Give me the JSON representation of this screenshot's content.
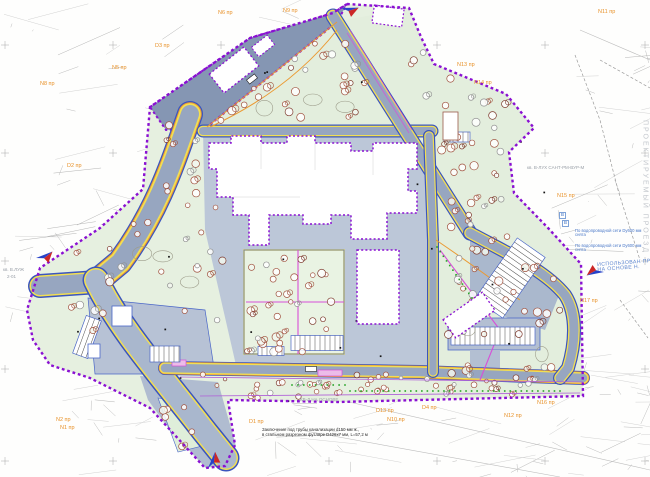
{
  "meta": {
    "drawing_type": "master-plan-site-drawing"
  },
  "palette": {
    "site_green": "#e6f0e0",
    "courtyard_green": "#e9f3e3",
    "road_slate": "#97a6c0",
    "parking_slate": "#8596b3",
    "paved_light": "#bcc7d8",
    "edge_yellow": "#f2df52",
    "curb_orange": "#eb9a33",
    "curb_blue": "#3b55be",
    "boundary_purple": "#8a10d2",
    "path_magenta": "#d84fd8",
    "tree_brick": "#a0523f",
    "tree_gray": "#909090",
    "dot_green": "#28a428",
    "label_orange": "#e8922a",
    "note_blue": "#4a78c8",
    "arrow_blue": "#2742c8",
    "arrow_red": "#cc2727"
  },
  "road_labels": [
    {
      "text": "N6 пр",
      "x": 218,
      "y": 11
    },
    {
      "text": "N9 пр",
      "x": 283,
      "y": 9
    },
    {
      "text": "N11 пр",
      "x": 598,
      "y": 10
    },
    {
      "text": "D3 пр",
      "x": 155,
      "y": 44
    },
    {
      "text": "N5 пр",
      "x": 112,
      "y": 66
    },
    {
      "text": "N8 пр",
      "x": 40,
      "y": 82
    },
    {
      "text": "D2 пр",
      "x": 67,
      "y": 164
    },
    {
      "text": "N13 пр",
      "x": 457,
      "y": 63
    },
    {
      "text": "N14 пр",
      "x": 474,
      "y": 81
    },
    {
      "text": "N15 пр",
      "x": 557,
      "y": 194
    },
    {
      "text": "N17 пр",
      "x": 580,
      "y": 299
    },
    {
      "text": "N16 пр",
      "x": 537,
      "y": 401
    },
    {
      "text": "N12 пр",
      "x": 504,
      "y": 414
    },
    {
      "text": "D4 пр",
      "x": 422,
      "y": 406
    },
    {
      "text": "D13 пр",
      "x": 376,
      "y": 409
    },
    {
      "text": "N10 пр",
      "x": 387,
      "y": 418
    },
    {
      "text": "D1 пр",
      "x": 249,
      "y": 420
    },
    {
      "text": "N2 пр",
      "x": 56,
      "y": 418
    },
    {
      "text": "N1 пр",
      "x": 60,
      "y": 426
    }
  ],
  "texture_labels": [
    {
      "text": "кв. В-ЛУХ  САНТ-РМ-ВУР-М",
      "x": 527,
      "y": 166
    },
    {
      "text": "кв. В.ЛУЖ",
      "x": 3,
      "y": 268
    },
    {
      "text": "2-01",
      "x": 7,
      "y": 275
    },
    {
      "text": "КВ-Л  НА ОСНОВЕ",
      "x": 300,
      "y": 398
    }
  ],
  "annotations": {
    "bottom_note": {
      "line1": "Заключение под трубы канализации d150 мм ж.,",
      "line2": "в стальном разрезном футляре D426х7 мм, L=57,2 м"
    },
    "route_note": {
      "line1": "ИСПОЛЬЗОВАН ПР.",
      "line2": "НА ОСНОВЕ Н."
    },
    "water_notes": [
      {
        "line1": "По водопроводной сети Dу600 мм",
        "line2": "снята",
        "x": 575,
        "y": 229
      },
      {
        "line1": "По водопроводной сети Dу600 мм",
        "line2": "снята",
        "x": 575,
        "y": 244
      }
    ],
    "v_markers": [
      {
        "text": "В",
        "x": 559,
        "y": 212
      },
      {
        "text": "В",
        "x": 562,
        "y": 220
      }
    ],
    "vertical_street_text": "ПРОЕКТИРУЕМЫЙ ПРОЕЗД"
  },
  "arrows": [
    {
      "name": "north-arrow-top",
      "x": 341,
      "y": 8,
      "rot": 15
    },
    {
      "name": "north-arrow-left",
      "x": 36,
      "y": 258,
      "rot": 355
    },
    {
      "name": "north-arrow-right",
      "x": 604,
      "y": 272,
      "rot": 185
    },
    {
      "name": "north-arrow-bottom",
      "x": 208,
      "y": 468,
      "rot": 310
    }
  ],
  "vegetation": {
    "deciduous_trees": 236,
    "shrub_dot_rows": 3,
    "lamp_dots": 28
  }
}
